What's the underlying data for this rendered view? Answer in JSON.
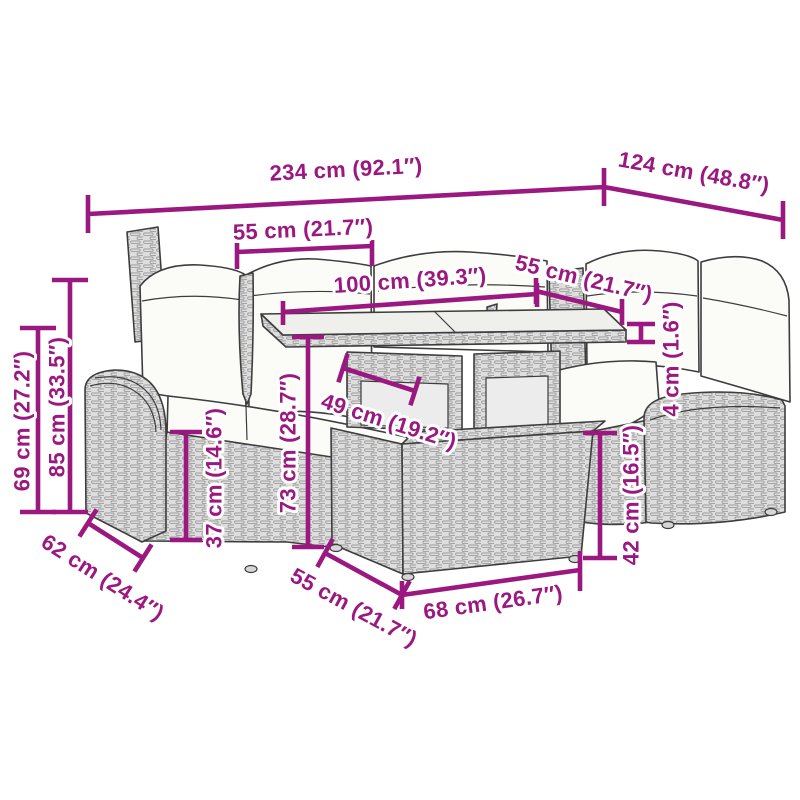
{
  "page": {
    "background": "#ffffff"
  },
  "colors": {
    "annotation": "#9a1880",
    "line_art": "#3d3d3d",
    "wicker_fill": "#dedede",
    "cushion_fill": "#fbfbf8",
    "glass_fill": "#efefec"
  },
  "dimensions": {
    "overall_width": "234 cm (92.1″)",
    "right_section_depth": "124 cm (48.8″)",
    "left_seat_width": "55 cm (21.7″)",
    "table_length": "100 cm (39.3″)",
    "right_seat_width": "55 cm (21.7″)",
    "overall_height": "85 cm (33.5″)",
    "armrest_height": "69 cm (27.2″)",
    "seat_height": "37 cm (14.6″)",
    "table_height": "73 cm (28.7″)",
    "table_base_depth": "49 cm (19.2″)",
    "tabletop_thickness": "4 cm (1.6″)",
    "ottoman_height": "42 cm (16.5″)",
    "seat_depth": "62 cm (24.4″)",
    "ottoman_depth": "55 cm (21.7″)",
    "ottoman_width": "68 cm (26.7″)"
  }
}
